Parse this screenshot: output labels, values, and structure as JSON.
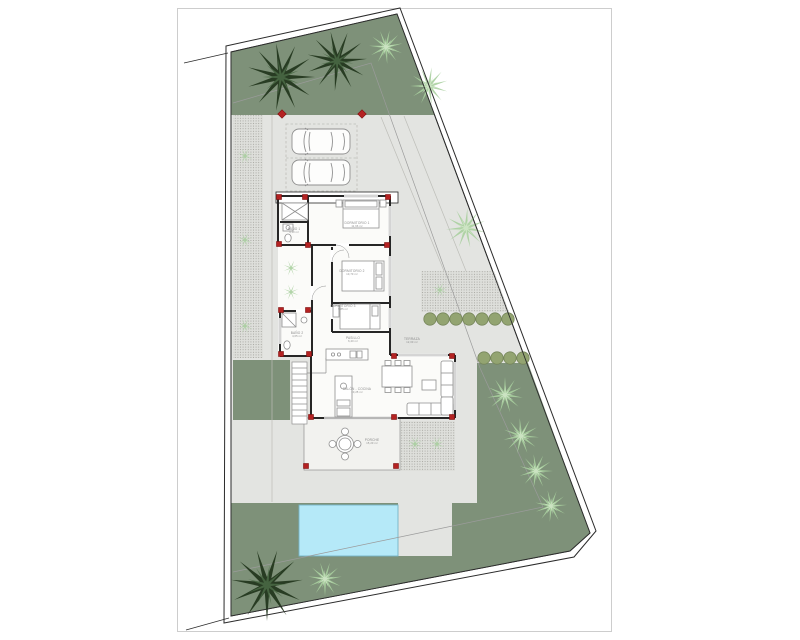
{
  "colors": {
    "lawn": "#7e9179",
    "paving": "#e3e4e1",
    "hatch_bg": "#dedfdb",
    "hatch_dot": "#a5a59f",
    "pool": "#b5e9f8",
    "pool_edge": "#74b4c6",
    "wall": "#262626",
    "boundary": "#2b2b2b",
    "column_red": "#b42222",
    "column_edge": "#7d1010",
    "furniture": "#909090",
    "palm_dark": "#24381f",
    "palm_dark_hi": "#4a6a45",
    "palm_light": "#a8cf9e",
    "palm_light_hi": "#d2e7c9",
    "bush": "#93a471",
    "bush_edge": "#75855a",
    "label": "#8a8a8a",
    "sheet_edge": "#cdcdcd",
    "slab": "#fbfbf9",
    "porch_slab": "#f2f2ef",
    "setback": "#9b9b9b",
    "faint": "#bdbdb8"
  },
  "rooms": [
    {
      "name": "DORMITORIO 1",
      "area": "11,96 m²",
      "x": 357,
      "y": 224
    },
    {
      "name": "DORMITORIO 2",
      "area": "10,70 m²",
      "x": 352,
      "y": 272
    },
    {
      "name": "DORMITORIO 3",
      "area": "9,85 m²",
      "x": 343,
      "y": 307
    },
    {
      "name": "BAÑO 1",
      "area": "4,10 m²",
      "x": 294,
      "y": 230
    },
    {
      "name": "BAÑO 2",
      "area": "4,65 m²",
      "x": 297,
      "y": 334
    },
    {
      "name": "PASILLO",
      "area": "6,40 m²",
      "x": 353,
      "y": 339
    },
    {
      "name": "SALÓN - COCINA",
      "area": "30,25 m²",
      "x": 357,
      "y": 390
    },
    {
      "name": "PORCHE",
      "area": "15,20 m²",
      "x": 372,
      "y": 441
    },
    {
      "name": "TERRAZA",
      "area": "12,00 m²",
      "x": 412,
      "y": 340
    }
  ],
  "site": {
    "columns": [
      [
        279,
        197
      ],
      [
        305,
        197
      ],
      [
        388,
        197
      ],
      [
        279,
        244
      ],
      [
        308,
        245
      ],
      [
        387,
        245
      ],
      [
        281,
        310
      ],
      [
        308,
        310
      ],
      [
        281,
        354
      ],
      [
        309,
        354
      ],
      [
        394,
        356
      ],
      [
        452,
        356
      ],
      [
        311,
        417
      ],
      [
        394,
        417
      ],
      [
        452,
        417
      ],
      [
        306,
        466
      ],
      [
        396,
        466
      ]
    ],
    "posts": [
      [
        282,
        114
      ],
      [
        362,
        114
      ]
    ],
    "palms": [
      {
        "x": 281,
        "y": 77,
        "r": 34,
        "tone": "dark"
      },
      {
        "x": 337,
        "y": 61,
        "r": 30,
        "tone": "dark"
      },
      {
        "x": 267,
        "y": 585,
        "r": 36,
        "tone": "dark"
      },
      {
        "x": 386,
        "y": 47,
        "r": 17,
        "tone": "light"
      },
      {
        "x": 429,
        "y": 86,
        "r": 19,
        "tone": "light"
      },
      {
        "x": 466,
        "y": 228,
        "r": 20,
        "tone": "light"
      },
      {
        "x": 505,
        "y": 395,
        "r": 18,
        "tone": "light"
      },
      {
        "x": 521,
        "y": 436,
        "r": 18,
        "tone": "light"
      },
      {
        "x": 536,
        "y": 471,
        "r": 17,
        "tone": "light"
      },
      {
        "x": 551,
        "y": 506,
        "r": 16,
        "tone": "light"
      },
      {
        "x": 325,
        "y": 579,
        "r": 17,
        "tone": "light"
      }
    ],
    "tufts": [
      [
        245,
        156
      ],
      [
        245,
        240
      ],
      [
        245,
        326
      ],
      [
        291,
        268
      ],
      [
        291,
        292
      ],
      [
        415,
        444
      ],
      [
        437,
        444
      ],
      [
        440,
        290
      ]
    ],
    "hedges": [
      {
        "y": 319,
        "xs": [
          430,
          443,
          456,
          469,
          482,
          495,
          508
        ]
      },
      {
        "y": 358,
        "xs": [
          484,
          497,
          510,
          523
        ]
      }
    ]
  }
}
